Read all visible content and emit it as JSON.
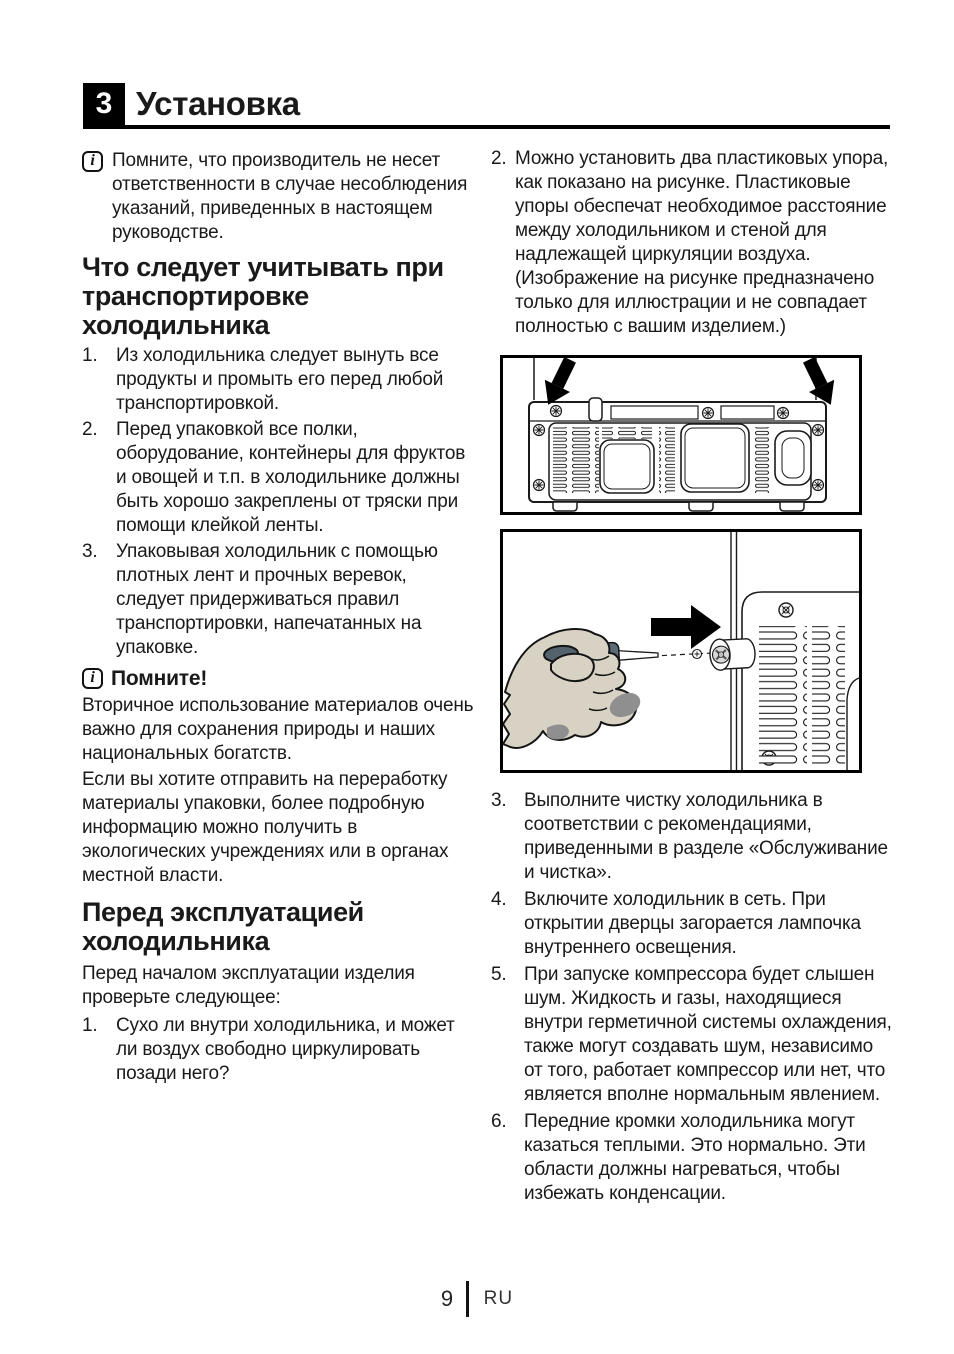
{
  "header": {
    "number": "3",
    "title": "Установка"
  },
  "icons": {
    "info_glyph": "i"
  },
  "left": {
    "manufacturer_note": "Помните, что производитель не несет ответственности в случае несоблюдения указаний, приведенных в настоящем руководстве.",
    "transport_heading": "Что следует учитывать при транспортировке холодильника",
    "transport_list": [
      {
        "num": "1.",
        "text": "Из холодильника следует вынуть все продукты и промыть его перед любой транспортировкой."
      },
      {
        "num": "2.",
        "text": "Перед упаковкой все полки, оборудование, контейнеры для фруктов и овощей и т.п. в холодильнике должны быть хорошо закреплены от тряски при помощи клейкой ленты."
      },
      {
        "num": "3.",
        "text": "Упаковывая холодильник с помощью плотных лент и прочных веревок, следует придерживаться правил транспортировки, напечатанных на упаковке."
      }
    ],
    "remember_label": "Помните!",
    "recycle_para_1": "Вторичное использование материалов очень важно для сохранения природы и наших национальных богатств.",
    "recycle_para_2": "Если вы хотите отправить на переработку материалы упаковки, более подробную информацию можно получить в экологических учреждениях или в органах местной власти.",
    "before_use_heading": "Перед эксплуатацией холодильника",
    "before_use_intro": "Перед началом эксплуатации изделия проверьте следующее:",
    "before_use_list": [
      {
        "num": "1.",
        "text": "Сухо ли внутри холодильника, и может ли воздух свободно циркулировать позади него?"
      }
    ]
  },
  "right": {
    "spacer_item": {
      "num": "2.",
      "text": "Можно установить два пластиковых упора, как показано на рисунке. Пластиковые упоры обеспечат необходимое расстояние между холодильником и стеной для надлежащей циркуляции воздуха. (Изображение на рисунке предназначено только для иллюстрации и не совпадает полностью с вашим изделием.)"
    },
    "figures": {
      "fig1_name": "fridge-back-spacer-locations-figure",
      "fig2_name": "screwdriver-installing-spacer-figure"
    },
    "steps": [
      {
        "num": "3.",
        "text": "Выполните чистку холодильника в соответствии с рекомендациями, приведенными в разделе «Обслуживание и чистка»."
      },
      {
        "num": "4.",
        "text": "Включите холодильник в сеть. При открытии дверцы загорается лампочка внутреннего освещения."
      },
      {
        "num": "5.",
        "text": "При запуске компрессора будет слышен шум. Жидкость и газы, находящиеся внутри герметичной системы охлаждения, также могут создавать шум, независимо от того, работает компрессор или нет, что является вполне нормальным явлением."
      },
      {
        "num": "6.",
        "text": "Передние кромки холодильника могут казаться теплыми. Это нормально. Эти области должны нагреваться, чтобы избежать конденсации."
      }
    ]
  },
  "footer": {
    "page_number": "9",
    "language": "RU"
  },
  "colors": {
    "line": "#1a1a1a",
    "hand_fill": "#d8d2c5",
    "grip_fill": "#5b6b76",
    "shade_gray": "#8f8f8f"
  }
}
